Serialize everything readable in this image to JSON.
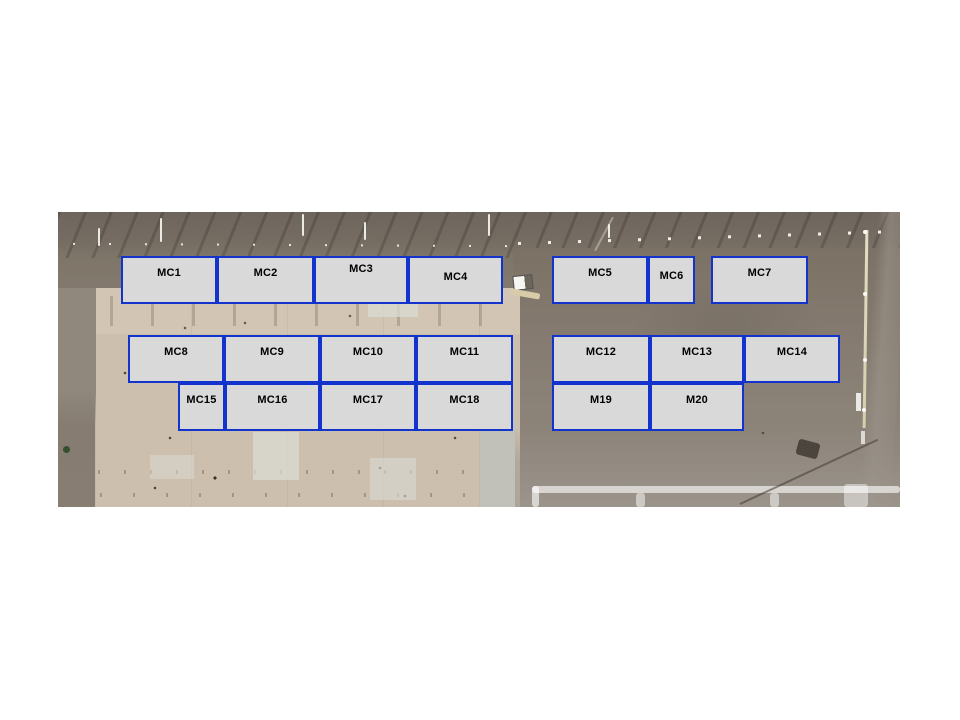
{
  "slide": {
    "background": "#ffffff"
  },
  "map": {
    "x": 58,
    "y": 212,
    "width": 842,
    "height": 295,
    "box_fill": "#d9d9d9",
    "box_border": "#1233cc",
    "label_color": "#000000",
    "boxes": [
      {
        "label": "MC1",
        "x": 121,
        "y": 256,
        "w": 96,
        "h": 48
      },
      {
        "label": "MC2",
        "x": 217,
        "y": 256,
        "w": 97,
        "h": 48
      },
      {
        "label": "MC3",
        "x": 314,
        "y": 256,
        "w": 94,
        "h": 48,
        "dy": -4
      },
      {
        "label": "MC4",
        "x": 408,
        "y": 256,
        "w": 95,
        "h": 48,
        "dy": 4
      },
      {
        "label": "MC5",
        "x": 552,
        "y": 256,
        "w": 96,
        "h": 48
      },
      {
        "label": "MC6",
        "x": 648,
        "y": 256,
        "w": 47,
        "h": 48,
        "dy": 3
      },
      {
        "label": "MC7",
        "x": 711,
        "y": 256,
        "w": 97,
        "h": 48
      },
      {
        "label": "MC8",
        "x": 128,
        "y": 335,
        "w": 96,
        "h": 48
      },
      {
        "label": "MC9",
        "x": 224,
        "y": 335,
        "w": 96,
        "h": 48
      },
      {
        "label": "MC10",
        "x": 320,
        "y": 335,
        "w": 96,
        "h": 48
      },
      {
        "label": "MC11",
        "x": 416,
        "y": 335,
        "w": 97,
        "h": 48
      },
      {
        "label": "MC12",
        "x": 552,
        "y": 335,
        "w": 98,
        "h": 48
      },
      {
        "label": "MC13",
        "x": 650,
        "y": 335,
        "w": 94,
        "h": 48
      },
      {
        "label": "MC14",
        "x": 744,
        "y": 335,
        "w": 96,
        "h": 48
      },
      {
        "label": "MC15",
        "x": 178,
        "y": 383,
        "w": 47,
        "h": 48
      },
      {
        "label": "MC16",
        "x": 225,
        "y": 383,
        "w": 95,
        "h": 48
      },
      {
        "label": "MC17",
        "x": 320,
        "y": 383,
        "w": 96,
        "h": 48
      },
      {
        "label": "MC18",
        "x": 416,
        "y": 383,
        "w": 97,
        "h": 48
      },
      {
        "label": "M19",
        "x": 552,
        "y": 383,
        "w": 98,
        "h": 48
      },
      {
        "label": "M20",
        "x": 650,
        "y": 383,
        "w": 94,
        "h": 48
      }
    ]
  }
}
